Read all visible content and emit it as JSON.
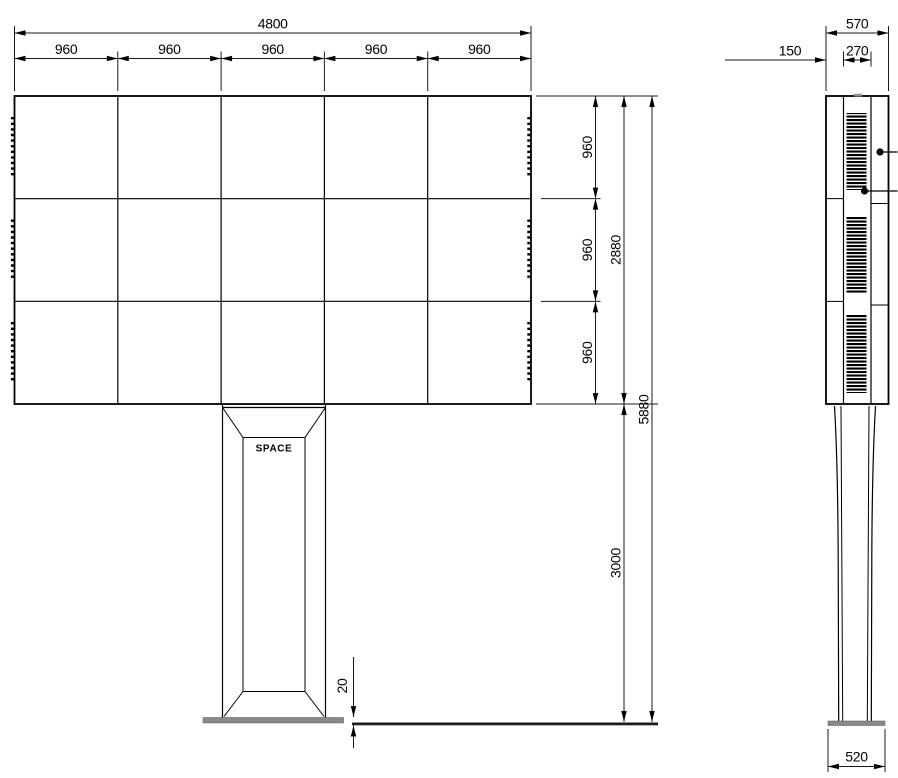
{
  "front_view": {
    "total_width": "4800",
    "module_widths": [
      "960",
      "960",
      "960",
      "960",
      "960"
    ],
    "module_heights": [
      "960",
      "960",
      "960"
    ],
    "screen_height": "2880",
    "overall_height": "5880",
    "column_height": "3000",
    "foundation_plate_thickness": "20",
    "pedestal_label": "SPACE"
  },
  "side_view": {
    "total_depth": "570",
    "front_section_depth": "150",
    "vent_section_depth": "270",
    "base_plate_width": "520"
  },
  "colors": {
    "line": "#000000",
    "plate_fill": "#8a8a8a",
    "ground_fill": "#1c1c1c",
    "background": "#ffffff"
  }
}
